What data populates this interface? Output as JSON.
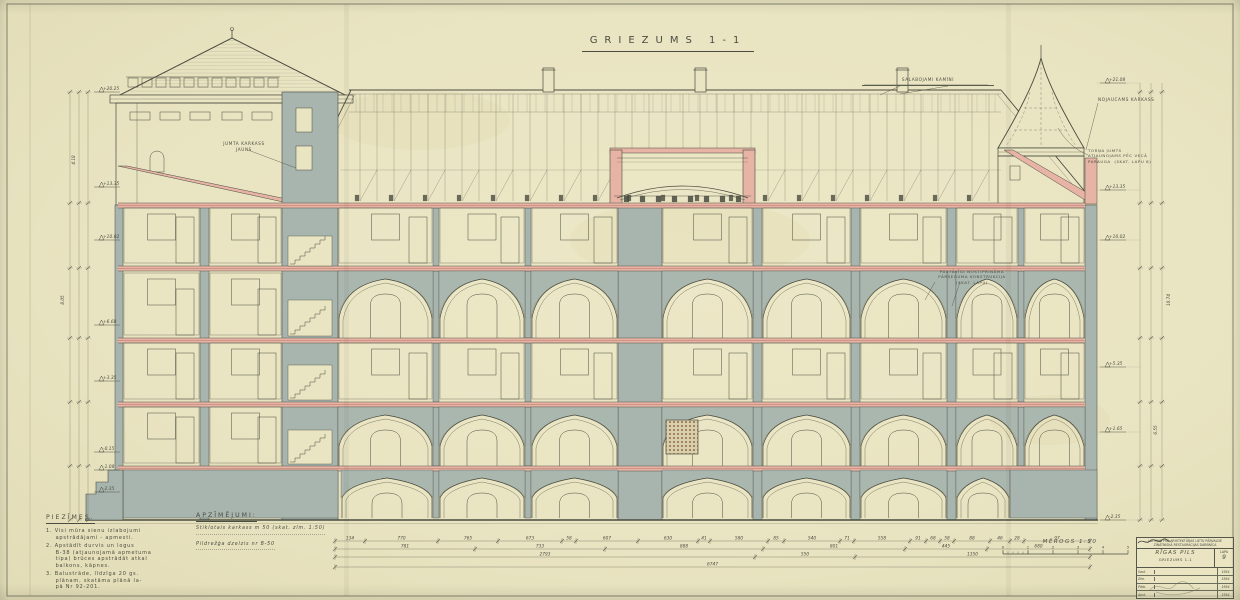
{
  "sheet": {
    "title": "GRIEZUMS  1-1"
  },
  "annotations": {
    "roof_left": "JUMTA KARKASS\nJAUNS",
    "chimneys": "SALABOJAMI KAMĪNI",
    "cornice_right": "NOJAUCAMS KARKASS",
    "spire": "TORŅA JUMTS\nATJAUNOJAMS PĒC VECĀ\nPARAUGA  (SKAT. LAPU 8)",
    "mid_wall": "PASTĀVĪGI NOSTIPRINĀMA\nPĀRSEGUMA KONSTRUKCIJA\n(SKAT. LAPU)"
  },
  "notes": {
    "heading": "PIEZĪMES.",
    "items": [
      "1. Visi mūra sienu izlabojumi\n    apstrādājami - apmesti.",
      "2. Apstādīt durvis un logus\n    B-38 (atjaunojamā apmetuma\n    tipa) brūces apstrādāt atkal\n    balkons, kāpnes.",
      "3. Balustrāde, līdzīga 20 gs.\n    plānam, skatāma plānā la-\n    pā Nr 92-201."
    ]
  },
  "legend": {
    "heading": "APZĪMĒJUMI:",
    "lines": [
      "Stiklotais karkass m 50 (skat. zīm. 1:50)",
      "Pildrežģa dzelzis  nr B-50"
    ]
  },
  "scalebar": {
    "label": "MĒROGS 1:50",
    "ticks": [
      "0",
      "1",
      "2",
      "3",
      "4",
      "5"
    ]
  },
  "elevations": {
    "left": [
      [
        92,
        "+20.25"
      ],
      [
        187,
        "+13.35"
      ],
      [
        240,
        "+10.02"
      ],
      [
        325,
        "+6.68"
      ],
      [
        381,
        "+3.35"
      ],
      [
        452,
        "-0.15"
      ],
      [
        470,
        "-1.08"
      ],
      [
        492,
        "-2.35"
      ]
    ],
    "right": [
      [
        83,
        "+21.08"
      ],
      [
        190,
        "+13.35"
      ],
      [
        240,
        "+10.02"
      ],
      [
        367,
        "+5.35"
      ],
      [
        432,
        "+1.65"
      ],
      [
        520,
        "-2.35"
      ]
    ],
    "left_chain_totals": [
      "8.05",
      "4.18"
    ],
    "right_chain_totals": [
      "10.74",
      "6.55"
    ]
  },
  "dimensions": {
    "rows": [
      {
        "y": 541,
        "x0": 335,
        "segs": [
          [
            "134",
            30
          ],
          [
            "770",
            73
          ],
          [
            "765",
            60
          ],
          [
            "673",
            64
          ],
          [
            "58",
            14
          ],
          [
            "607",
            62
          ],
          [
            "630",
            60
          ],
          [
            "41",
            12
          ],
          [
            "580",
            58
          ],
          [
            "85",
            16
          ],
          [
            "540",
            56
          ],
          [
            "71",
            14
          ],
          [
            "558",
            56
          ],
          [
            "91",
            16
          ],
          [
            "68",
            14
          ],
          [
            "58",
            14
          ],
          [
            "88",
            36
          ],
          [
            "46",
            20
          ],
          [
            "28",
            14
          ],
          [
            "97",
            66
          ]
        ]
      },
      {
        "y": 549,
        "x0": 335,
        "segs": [
          [
            "781",
            140
          ],
          [
            "733",
            130
          ],
          [
            "888",
            158
          ],
          [
            "801",
            142
          ],
          [
            "445",
            82
          ],
          [
            "680",
            103
          ]
        ]
      },
      {
        "y": 557,
        "x0": 335,
        "segs": [
          [
            "2793",
            420
          ],
          [
            "550",
            100
          ],
          [
            "1350",
            235
          ]
        ]
      },
      {
        "y": 567,
        "x0": 335,
        "segs": [
          [
            "6747",
            755
          ]
        ]
      }
    ]
  },
  "titleblock": {
    "org": "LATVIJAS PSR ARHITEKTŪRAS LIETU PĀRVALDE\nZINĀTNISKĀ RESTAURĀCIJAS DARBNĪCA",
    "object": "RĪGAS PILS",
    "drawing": "GRIEZUMS 1-1",
    "sheet_label": "LAPA",
    "sheet_no": "9",
    "rows": [
      [
        "Sast.",
        "1954"
      ],
      [
        "Zīm.",
        "1954"
      ],
      [
        "Pārb.",
        "1954"
      ],
      [
        "Apst.",
        "1954"
      ]
    ]
  },
  "colors": {
    "paper": "#e9e4c2",
    "ink": "#4a4c40",
    "poche": "#a7b5ae",
    "brick": "#e6b3a4",
    "brick_line": "#a85a48"
  }
}
